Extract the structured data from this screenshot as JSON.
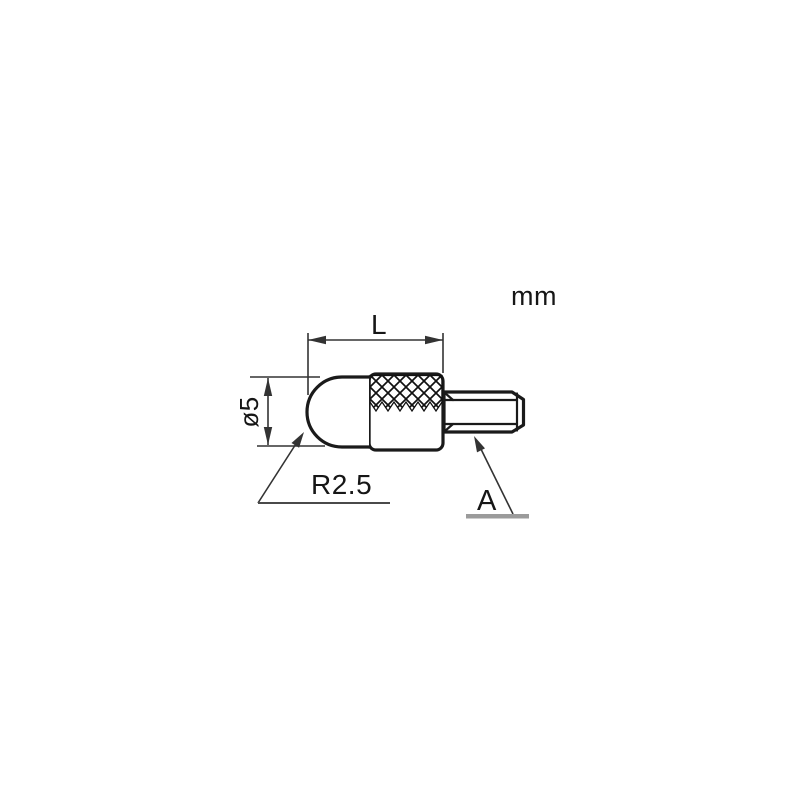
{
  "title": "Contact point dimensional drawing",
  "units_label": "mm",
  "dimensions": {
    "length_label": "L",
    "diameter_label": "ø5",
    "radius_label": "R2.5",
    "surface_label": "A"
  },
  "colors": {
    "line": "#1a1a1a",
    "dim_line": "#333333",
    "underline_gray": "#9b9b9b",
    "background": "#ffffff"
  }
}
